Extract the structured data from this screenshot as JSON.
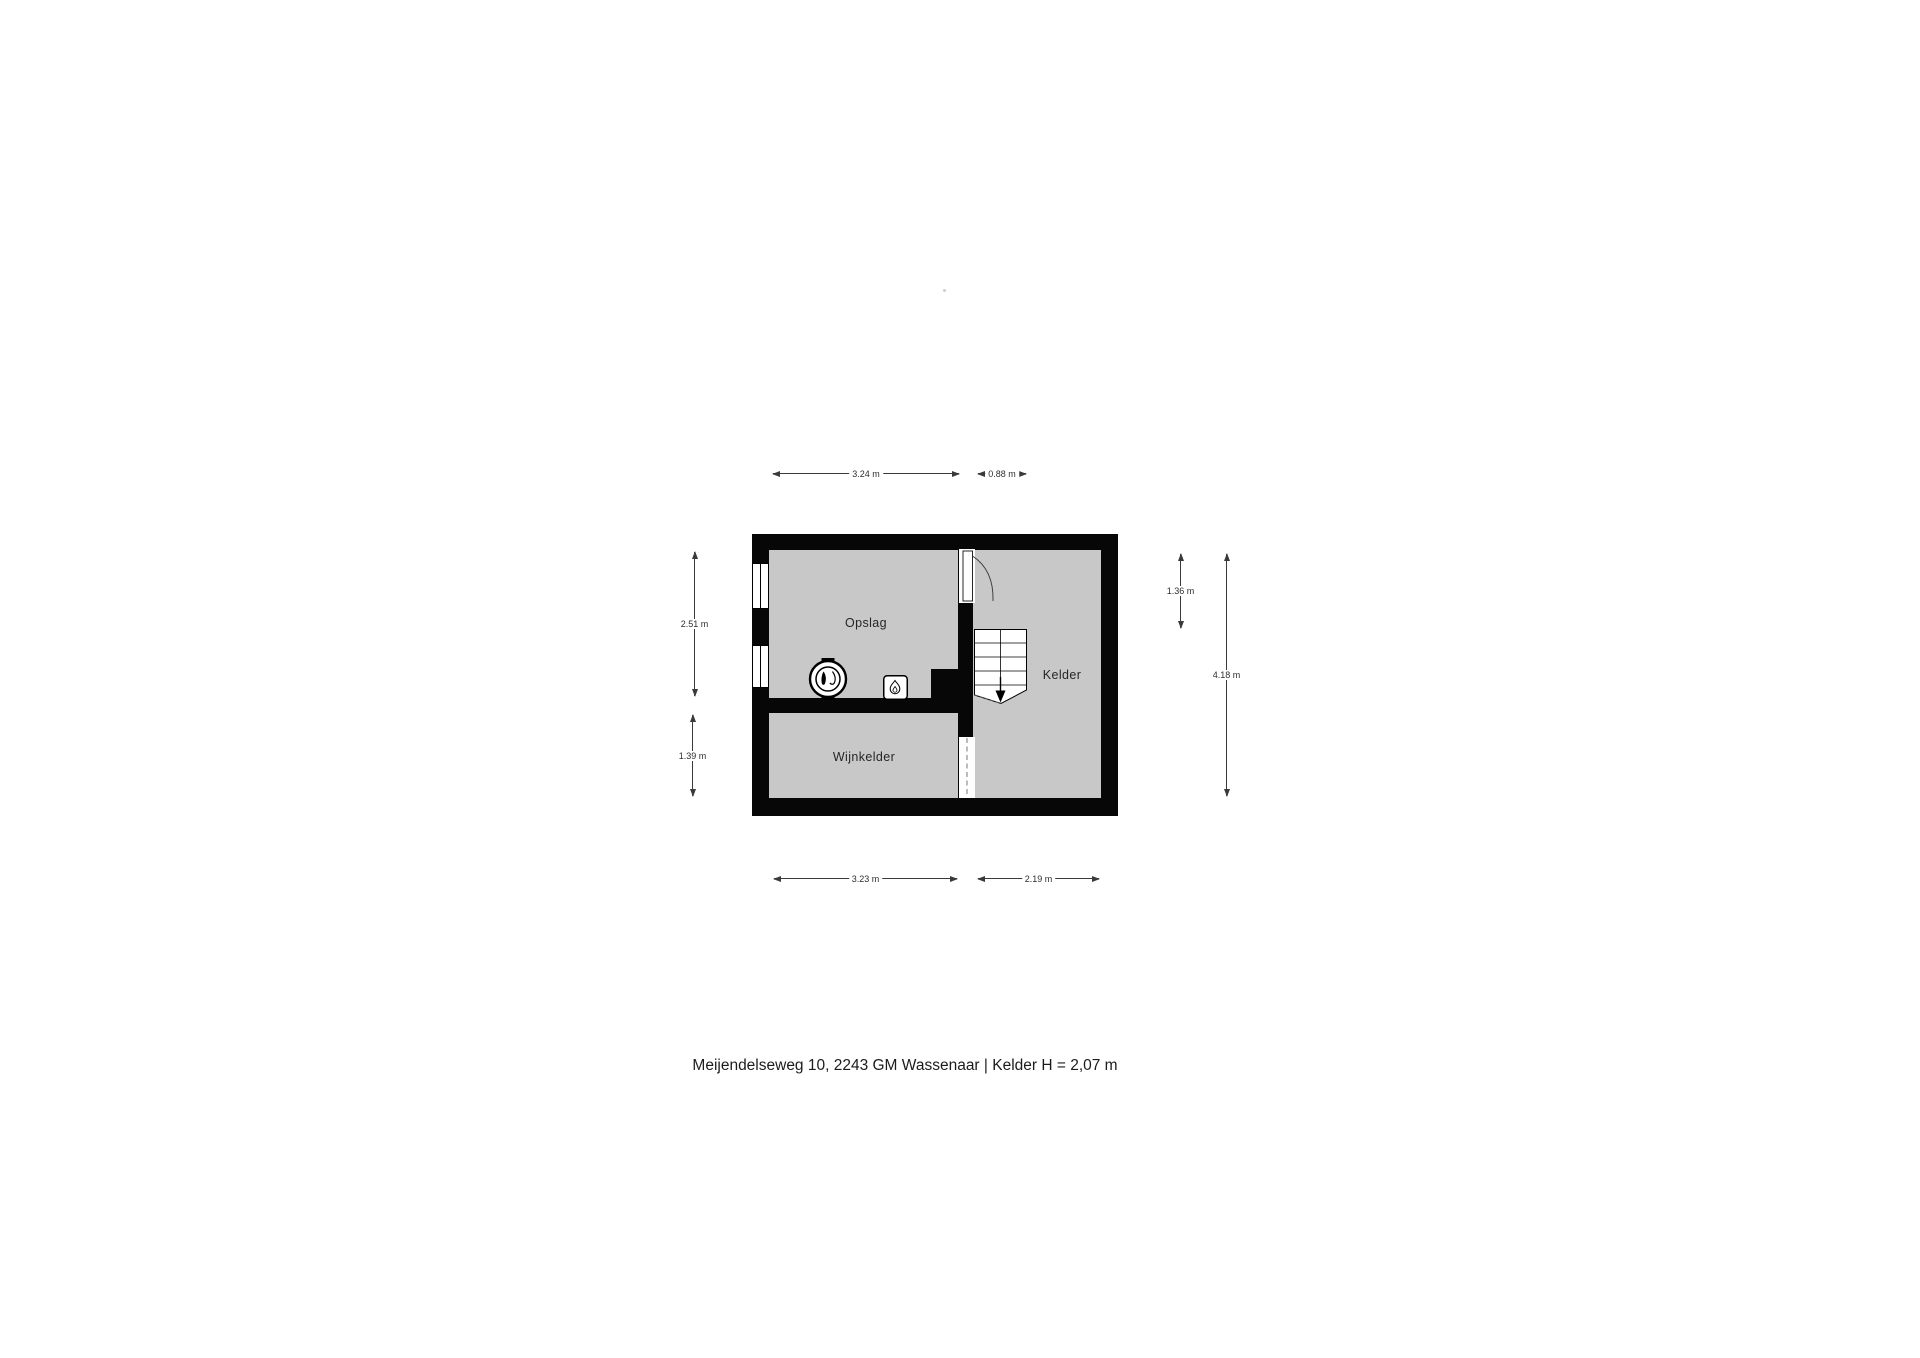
{
  "rooms": {
    "opslag": "Opslag",
    "kelder": "Kelder",
    "wijnkelder": "Wijnkelder"
  },
  "dimensions": {
    "top_left": "3.24 m",
    "top_right": "0.88 m",
    "left_upper": "2.51 m",
    "left_lower": "1.39 m",
    "right_inner": "1.36 m",
    "right_outer": "4.18 m",
    "bottom_left": "3.23 m",
    "bottom_right": "2.19 m"
  },
  "caption": "Meijendelseweg 10, 2243 GM Wassenaar | Kelder H = 2,07 m",
  "icons": {
    "windows": "window-icon",
    "door": "door-swing-icon",
    "stairs": "stairs-down-arrow-icon",
    "boiler": "boiler-icon",
    "water_heater": "water-heater-flame-icon",
    "passage": "open-passage-dashed-icon"
  },
  "colors": {
    "background": "#ffffff",
    "wall": "#070707",
    "room_fill": "#c8c8c8",
    "dimension_line": "#3a3a3a",
    "label_text": "#262626"
  }
}
